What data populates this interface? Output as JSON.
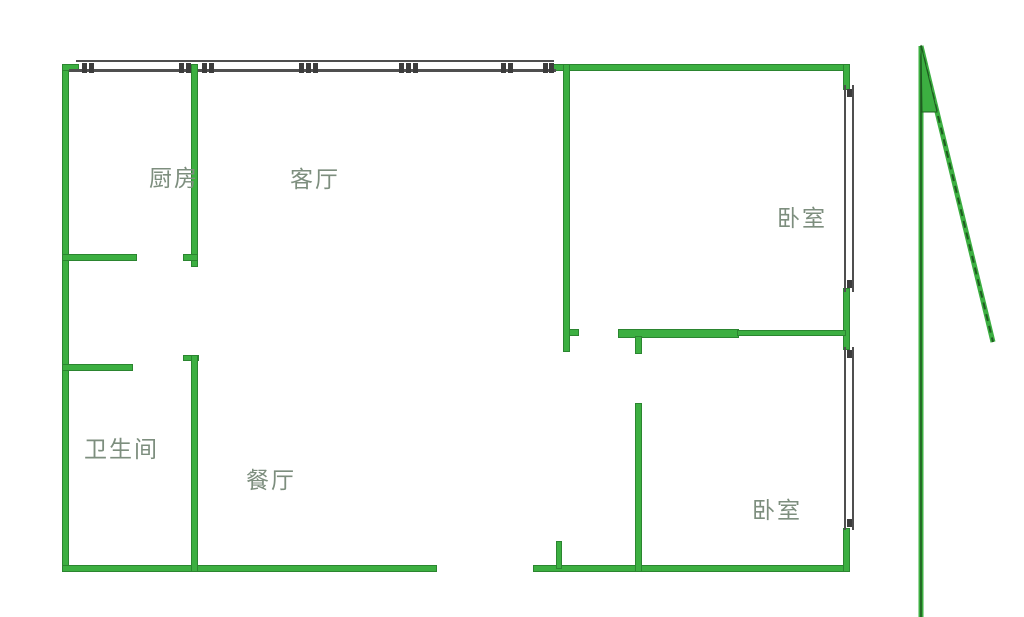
{
  "title": "户型图",
  "rooms": [
    {
      "name": "kitchen",
      "label": "厨房"
    },
    {
      "name": "living-room",
      "label": "客厅"
    },
    {
      "name": "bedroom-top",
      "label": "卧室"
    },
    {
      "name": "bathroom",
      "label": "卫生间"
    },
    {
      "name": "dining-room",
      "label": "餐厅"
    },
    {
      "name": "bedroom-bottom",
      "label": "卧室"
    }
  ],
  "icons": {
    "north_arrow": "north-arrow-line"
  },
  "colors": {
    "wall": "#3caf41",
    "wall_dark": "#2b8530",
    "window": "#4f4f4f",
    "label": "#7d8e7e",
    "bg": "#ffffff",
    "arrow_dark": "#1e5c20"
  }
}
